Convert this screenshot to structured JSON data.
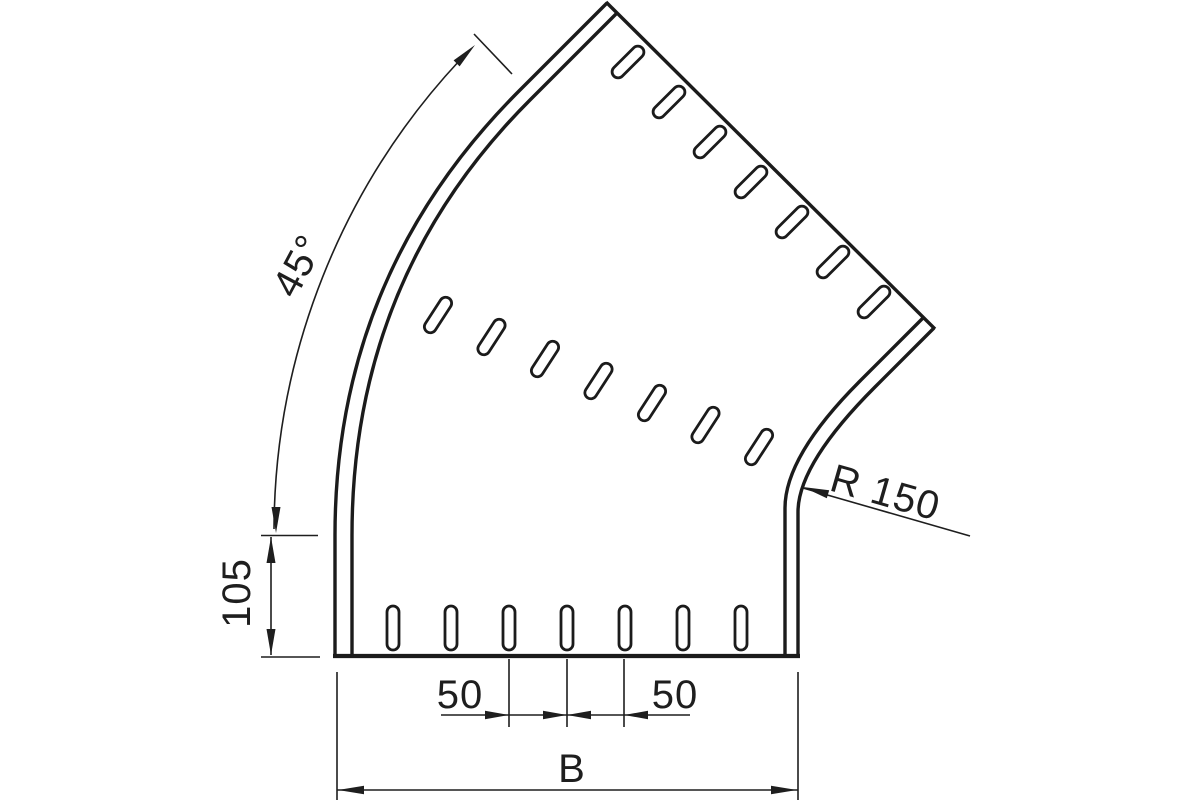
{
  "drawing": {
    "background_color": "#ffffff",
    "line_color": "#1b1b1b",
    "labels": {
      "angle": "45°",
      "straight_length": "105",
      "bend_radius": "R 150",
      "hole_spacing_left": "50",
      "hole_spacing_right": "50",
      "overall_width": "B"
    }
  }
}
